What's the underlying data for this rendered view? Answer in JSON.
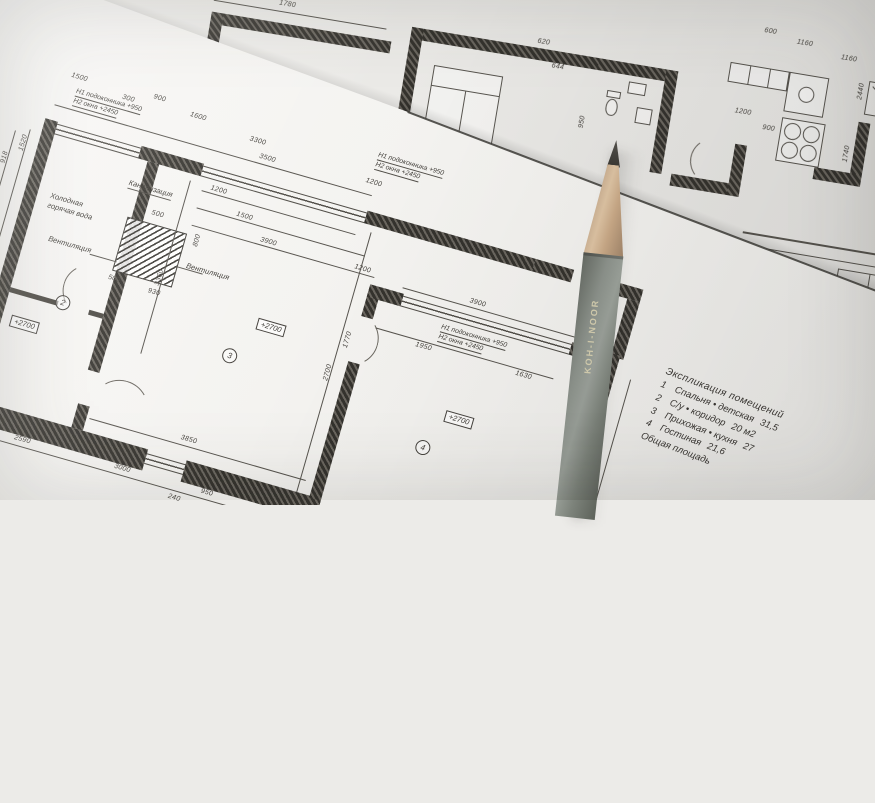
{
  "colors": {
    "paper_front": "#f6f5f2",
    "paper_back": "#ecebe8",
    "ink": "#3b3935",
    "pencil_body": "#868c85",
    "pencil_wood": "#cbab89",
    "graphite": "#44423d"
  },
  "labels": {
    "sill_note_line1": "Н1 подоконника  +950",
    "sill_note_line2": "Н2 окна  +2450",
    "sewer": "Канализация",
    "water_line1": "Холодная",
    "water_line2": "горячая вода",
    "vent": "Вентиляция",
    "elevation": "+2700"
  },
  "rooms": [
    "2",
    "3",
    "4"
  ],
  "dims": {
    "mt": [
      "1500",
      "300",
      "900",
      "1600",
      "3300",
      "3500",
      "1200"
    ],
    "win": [
      "1200",
      "1500",
      "3900",
      "1200",
      "3360"
    ],
    "ml": [
      "1520",
      "918",
      "2700",
      "3640",
      "3000",
      "1000",
      "400"
    ],
    "mb": [
      "2590",
      "3000",
      "240",
      "950",
      "300",
      "3850",
      "3900"
    ],
    "r4": [
      "3900",
      "1950",
      "1630",
      "1770",
      "5420",
      "3010",
      "2700"
    ],
    "vent": [
      "500",
      "930",
      "800",
      "500"
    ],
    "up": [
      "1780",
      "950",
      "620",
      "644",
      "600",
      "1160",
      "1160",
      "900",
      "1200",
      "2440",
      "1740"
    ]
  },
  "explication": {
    "title": "Экспликация помещений",
    "rows": [
      {
        "num": "1",
        "name": "Спальня • детская",
        "area": "31,5"
      },
      {
        "num": "2",
        "name": "С/у • коридор",
        "area": "20 м2"
      },
      {
        "num": "3",
        "name": "Прихожая • кухня",
        "area": "27"
      },
      {
        "num": "4",
        "name": "Гостиная",
        "area": "21,6"
      }
    ],
    "footer": "Общая площадь"
  },
  "pencil": {
    "brand": "KOH-I-NOOR"
  }
}
